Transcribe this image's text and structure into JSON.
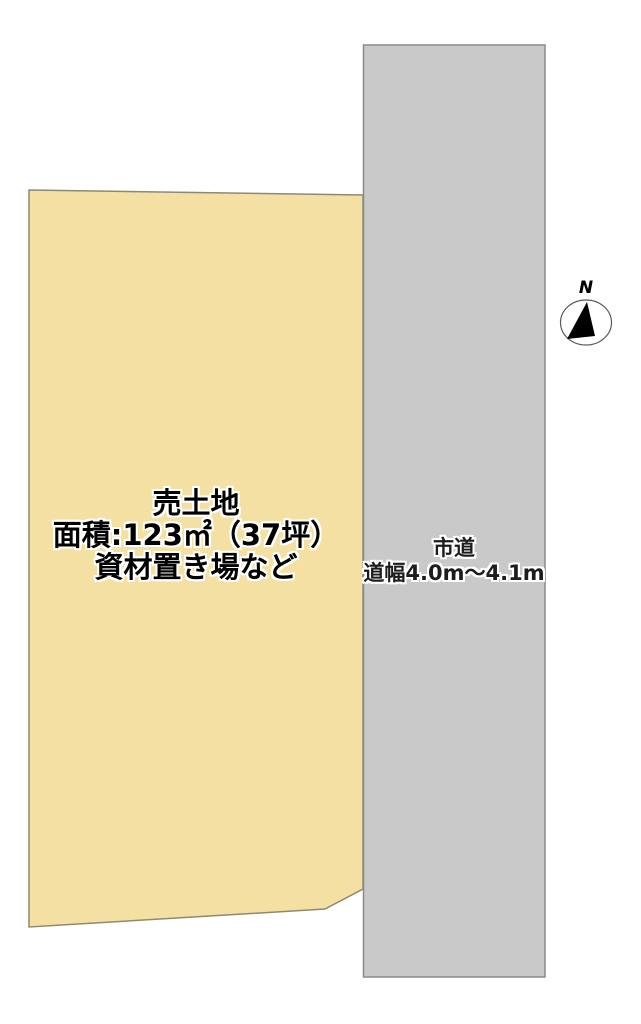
{
  "diagram": {
    "type": "real-estate-plot-plan",
    "parcel": {
      "title": "売土地",
      "area": "面積:123㎡（37坪）",
      "note": "資材置き場など",
      "fill_color": "#f4e0a2",
      "border_color": "#8d8a72"
    },
    "road": {
      "name": "市道",
      "width_range": "道幅4.0m～4.1m",
      "fill_color": "#c9c9c9",
      "border_color": "#8a8a8a"
    },
    "compass": {
      "label": "N"
    },
    "background_color": "#ffffff"
  }
}
